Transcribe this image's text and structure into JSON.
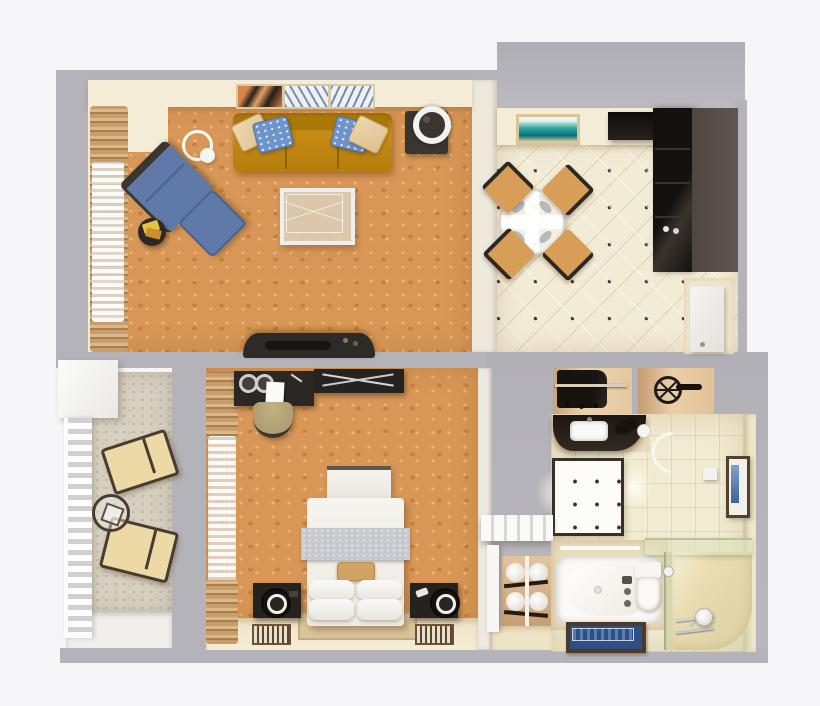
{
  "meta": {
    "description": "3D architectural floor plan of a one-bedroom hotel suite, rendered top-down on a plain light background",
    "view": "top-down 3D render",
    "has_text": false
  },
  "palette": {
    "bg": "#f6f6f8",
    "wall": "#b4b3b9",
    "wall-dark": "#a9a8ae",
    "soffit": "#f4ecd7",
    "carpet": "#d99757",
    "carpet-motif": "#c57f3e",
    "tile": "#f2ebd6",
    "tile-dot": "#433527",
    "bath-tile": "#f2ebd2",
    "balcony-floor": "#d7cfc0",
    "curtain-tan": "#c79e6b",
    "sofa": "#bd8512",
    "pillow-blue": "#6d94cc",
    "pillow-tan": "#e7cda2",
    "chair-blue": "#5f79a8",
    "kitchen-dark": "#1b1815",
    "kitchen-taupe": "#5a524b",
    "bed-white": "#f4f2ed",
    "runner-gray": "#c6c9cf",
    "night-dark": "#262220",
    "lounger": "#ecd9a6",
    "niche-tan": "#e2c098",
    "vanity-dark": "#241d18",
    "mat-blue": "#2e4f86",
    "mat-border": "#4e3a26",
    "art-teal": "#2aa0a0"
  },
  "rooms": {
    "living_room": {
      "name": "living room",
      "floor": "orange patterned carpet",
      "furniture": [
        "three-seat mustard sofa with two blue and two tan pillows",
        "wall art triptych above sofa",
        "end table with round lamp",
        "arc floor lamp",
        "blue armchair",
        "blue ottoman",
        "round side table with yellow books",
        "glass coffee table",
        "dark TV media console",
        "tan curtains with white sheers"
      ]
    },
    "dining_kitchen": {
      "name": "dining area with kitchenette",
      "floor": "cream diagonal tile with dot inlays",
      "furniture": [
        "round glass dining table with white cross runner and four place settings",
        "four tan dining chairs",
        "framed beach artwork",
        "black kitchenette counter",
        "tall dark kitchenette cabinet",
        "suite entry door"
      ]
    },
    "bedroom": {
      "name": "bedroom",
      "floor": "orange patterned carpet with cream walkway strip",
      "furniture": [
        "double bed with gray runner, tan accent pillow and four white pillows",
        "white bench at foot of bed",
        "two dark nightstands with round lamps",
        "two floor vent mats",
        "writing desk with coffee service and notepad",
        "olive desk chair",
        "dark dresser with folding luggage rack",
        "tan curtains with white sheers"
      ]
    },
    "balcony": {
      "name": "balcony",
      "floor": "speckled stone",
      "furniture": [
        "white storage cabinet",
        "white railing",
        "two cushioned sun loungers",
        "round glass side table"
      ]
    },
    "bathroom": {
      "name": "bathroom",
      "floor": "beige tile",
      "furniture": [
        "open closet niche with hanging clothes",
        "niche with wall-mounted fan",
        "curved dark vanity with white sink and hair dryer",
        "ceiling light panel with two lit lamps",
        "bathtub with wall faucet",
        "toilet",
        "glass shower enclosure with hand shower and grab bars",
        "blue bath mat with dark border",
        "framed blue artwork",
        "tissue box on wall"
      ]
    },
    "entry_hall": {
      "name": "entry hall",
      "furniture": [
        "white slatted shelf",
        "towel niche with rolled white towels",
        "white door leaf"
      ]
    }
  }
}
